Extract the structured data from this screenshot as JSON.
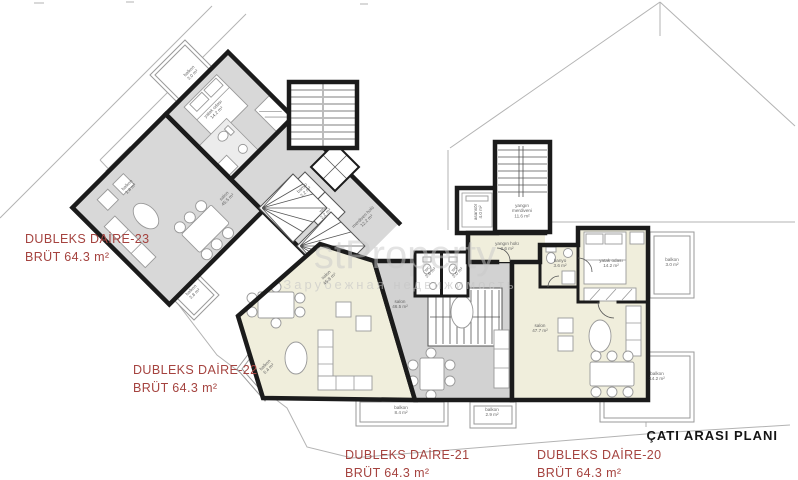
{
  "plan": {
    "title": "ÇATI ARASI PLANI",
    "watermark_brand": "stProperty",
    "watermark_subtitle": "Зарубежная недвижимость"
  },
  "apartments": [
    {
      "id": "daire-23",
      "name": "DUBLEKS DAİRE-23",
      "area": "BRÜT 64.3 m²"
    },
    {
      "id": "daire-22",
      "name": "DUBLEKS DAİRE-22",
      "area": "BRÜT 64.3 m²"
    },
    {
      "id": "daire-21",
      "name": "DUBLEKS DAİRE-21",
      "area": "BRÜT 64.3 m²"
    },
    {
      "id": "daire-20",
      "name": "DUBLEKS DAİRE-20",
      "area": "BRÜT 64.3 m²"
    }
  ],
  "rooms": {
    "d23_balkon_top": {
      "name": "balkon",
      "area": "3.0 m²"
    },
    "d23_bedroom": {
      "name": "yatak odası",
      "area": "14.2 m²"
    },
    "d23_salon": {
      "name": "salon",
      "area": "45.5 m²"
    },
    "d23_balkon_left": {
      "name": "balkon",
      "area": "1.4 m²"
    },
    "d23_balkon_bottom": {
      "name": "balkon",
      "area": "3.8 m²"
    },
    "core_banyo": {
      "name": "banyo",
      "area": "2.2 m²"
    },
    "core_wc": {
      "name": "wc",
      "area": "2.2 m²"
    },
    "core_hall": {
      "name": "merdiven holü",
      "area": "12.2 m²"
    },
    "d22_salon": {
      "name": "salon",
      "area": "45.8 m²"
    },
    "d22_balkon": {
      "name": "balkon",
      "area": "6.4 m²"
    },
    "d21_salon": {
      "name": "salon",
      "area": "46.5 m²"
    },
    "d21_balkon_1": {
      "name": "balkon",
      "area": "8.4 m²"
    },
    "d21_balkon_2": {
      "name": "balkon",
      "area": "2.9 m²"
    },
    "wc_1": {
      "name": "wc",
      "area": "3.0 m²"
    },
    "wc_2": {
      "name": "wc",
      "area": "3.0 m²"
    },
    "fire_stairs": {
      "line1": "yangın",
      "line2": "merdiveni",
      "area": "11.6 m²"
    },
    "fire_hall": {
      "name": "yangın holü",
      "area": "2.6 m²"
    },
    "elevator": {
      "name": "asansör",
      "area": "4.0 m²"
    },
    "d20_banyo": {
      "name": "banyo",
      "area": "3.6 m²"
    },
    "d20_bedroom": {
      "name": "yatak odası",
      "area": "14.2 m²"
    },
    "d20_salon": {
      "name": "salon",
      "area": "47.7 m²"
    },
    "d20_balkon_right": {
      "name": "balkon",
      "area": "3.0 m²"
    },
    "d20_balkon_bottom": {
      "name": "balkon",
      "area": "14.2 m²"
    }
  },
  "colors": {
    "accent_red": "#a5433f",
    "wall_black": "#1b1b1b",
    "room_gray": "#d8d8d8",
    "room_cream": "#f0eedc",
    "outline_gray": "#b3b3b3"
  }
}
